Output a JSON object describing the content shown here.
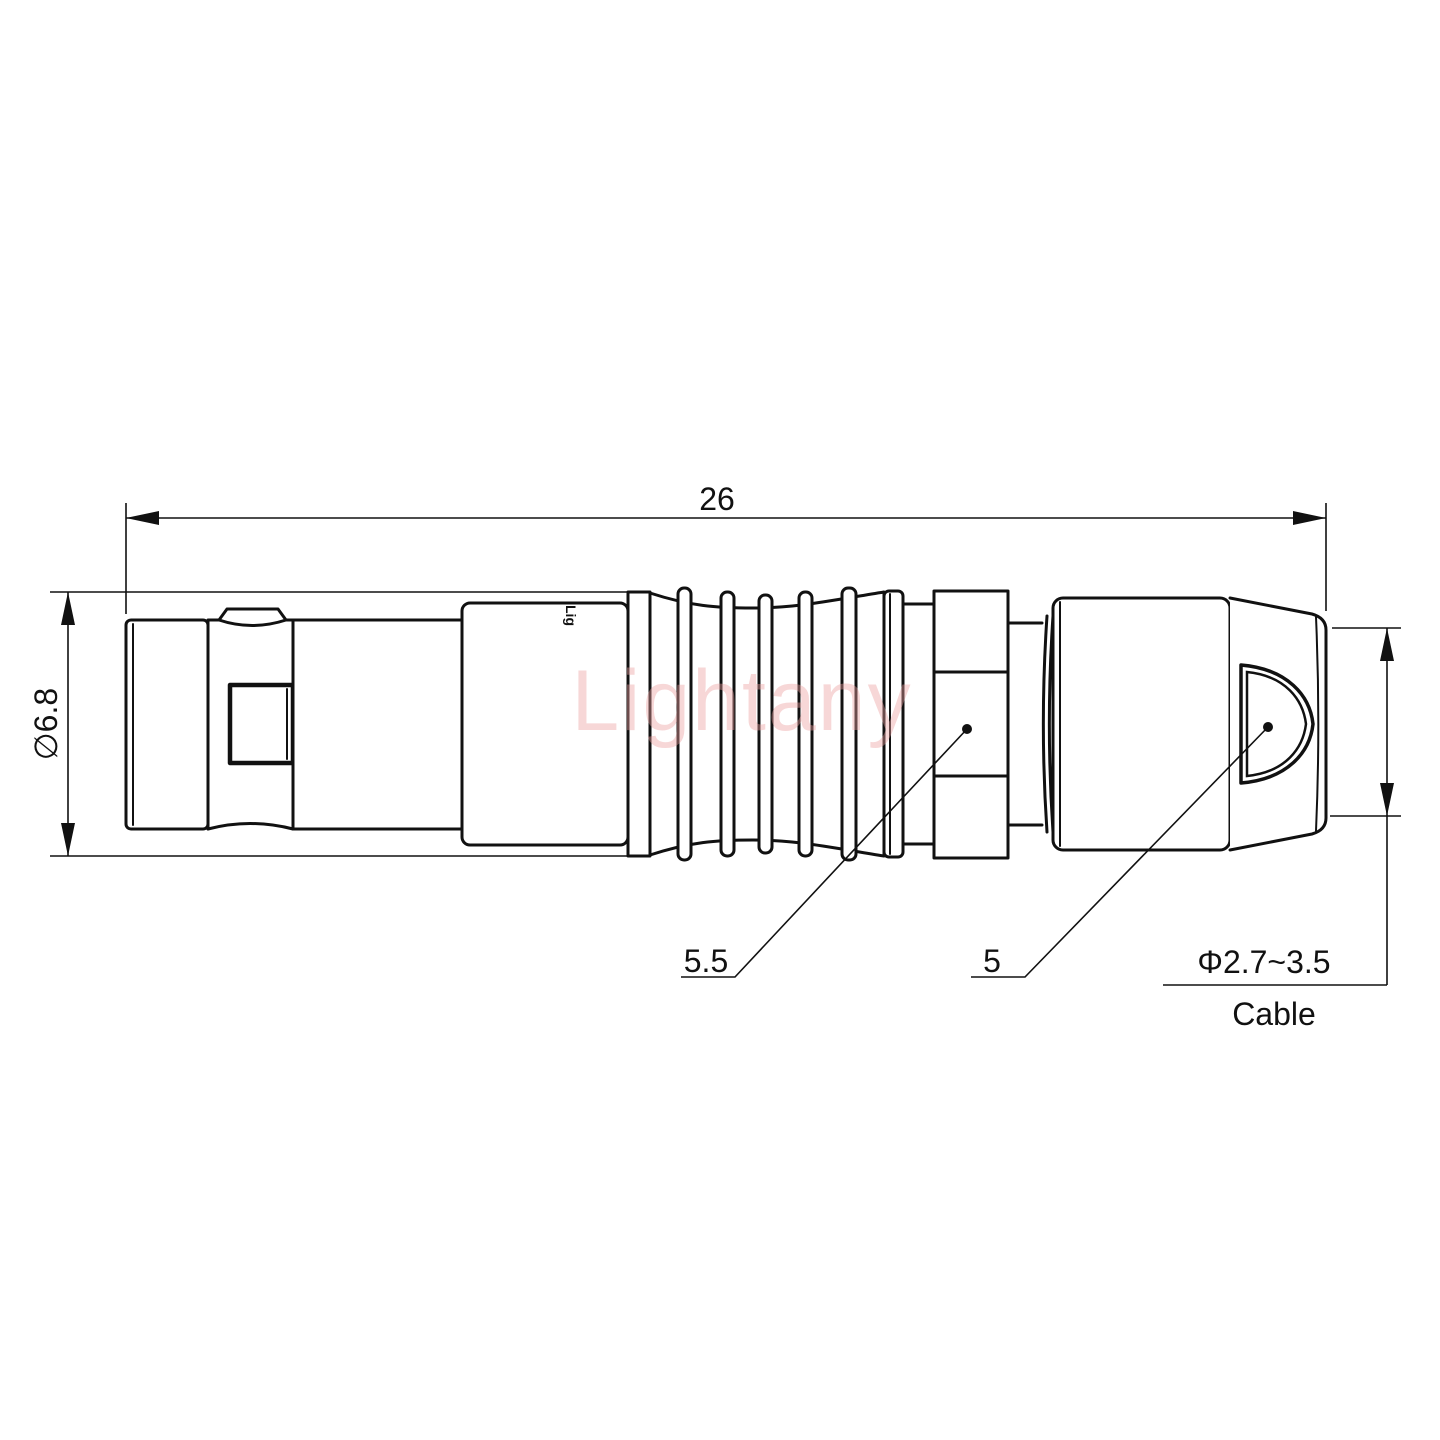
{
  "drawing": {
    "watermark": "Lightany",
    "body_logo": "Lig",
    "dimensions": {
      "overall_length": "26",
      "body_diameter": "∅6.8",
      "nut_size": "5.5",
      "boot_size": "5",
      "cable_range": "Φ2.7~3.5",
      "cable_label": "Cable"
    },
    "colors": {
      "line": "#111111",
      "watermark_pink": "#ec9f9f",
      "background": "#ffffff"
    }
  }
}
